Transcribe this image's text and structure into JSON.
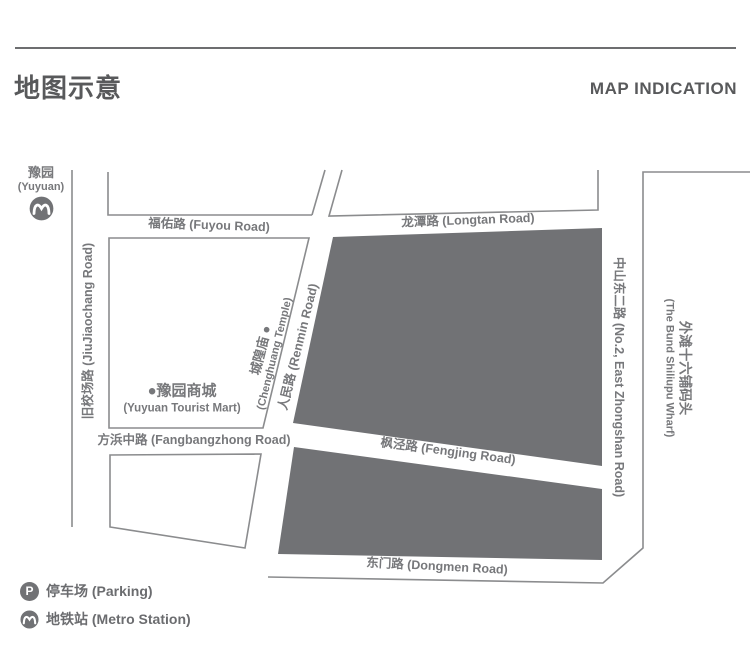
{
  "header": {
    "title_zh": "地图示意",
    "title_en": "MAP INDICATION"
  },
  "map": {
    "station": {
      "name_zh": "豫园",
      "name_en": "(Yuyuan)"
    },
    "roads": {
      "fuyou": "福佑路 (Fuyou Road)",
      "longtan": "龙潭路 (Longtan Road)",
      "jiujiaochang": "旧校场路 (JiuJiaochang Road)",
      "renmin": "人民路 (Renmin Road)",
      "fangbangzhong": "方浜中路 (Fangbangzhong Road)",
      "fengjing": "枫泾路 (Fengjing Road)",
      "dongmen": "东门路 (Dongmen Road)",
      "zhongshan": "中山东二路 (No.2, East Zhongshan Road)",
      "bund_zh": "外滩十六铺码头",
      "bund_en": "(The Bund Shiliupu Wharf)"
    },
    "pois": {
      "chenghuang_zh": "城隍庙 ●",
      "chenghuang_en": "(Chenghuang Temple)",
      "yuyuan_mart_zh": "●豫园商城",
      "yuyuan_mart_en": "(Yuyuan Tourist Mart)"
    }
  },
  "legend": {
    "parking_symbol": "P",
    "parking_label": "停车场 (Parking)",
    "metro_label": "地铁站 (Metro Station)"
  },
  "colors": {
    "block_fill": "#717275",
    "road_line": "#8b8c8e",
    "text_gray": "#77787b",
    "title_gray": "#58595b"
  }
}
